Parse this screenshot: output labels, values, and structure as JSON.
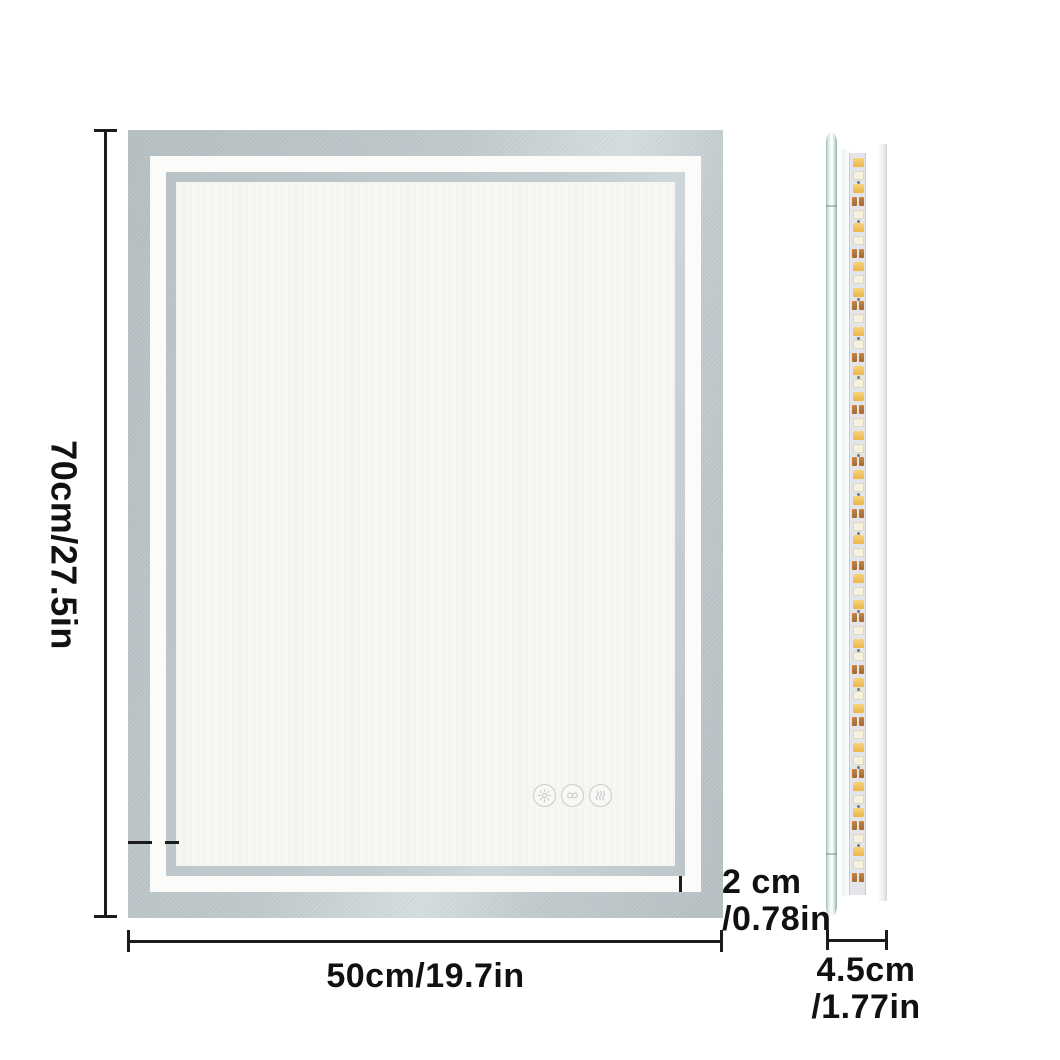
{
  "dimensions": {
    "height": "70cm/27.5in",
    "width": "50cm/19.7in",
    "frame_line1": "2 cm",
    "frame_line2": "/0.78in",
    "depth_line1": "4.5cm",
    "depth_line2": "/1.77in"
  },
  "touch_controls": [
    {
      "name": "touch-control-brightness",
      "icon": "sun-icon"
    },
    {
      "name": "touch-control-color-temperature",
      "icon": "color-temp-icon"
    },
    {
      "name": "touch-control-defog",
      "icon": "defog-waves-icon"
    }
  ],
  "led_strip": {
    "pattern": [
      "yellow",
      "cream",
      "yellow",
      "resistor",
      "cream",
      "yellow",
      "cream",
      "resistor"
    ],
    "row_spacing_px": 13
  },
  "colors": {
    "frame_outer": "#bcc6c9",
    "frame_inner_band": "#c0cacd",
    "frame_white": "#fbfcfa",
    "mirror_surface": "#f6f7f3",
    "dimension_line": "#1c1c1c",
    "label_text": "#111111",
    "touch_icon": "#c6cdc8",
    "glass_edge_green": "#9fc3b2",
    "led_yellow": "#eab64a",
    "led_cream": "#f6f2de",
    "resistor_orange": "#a5682e"
  }
}
